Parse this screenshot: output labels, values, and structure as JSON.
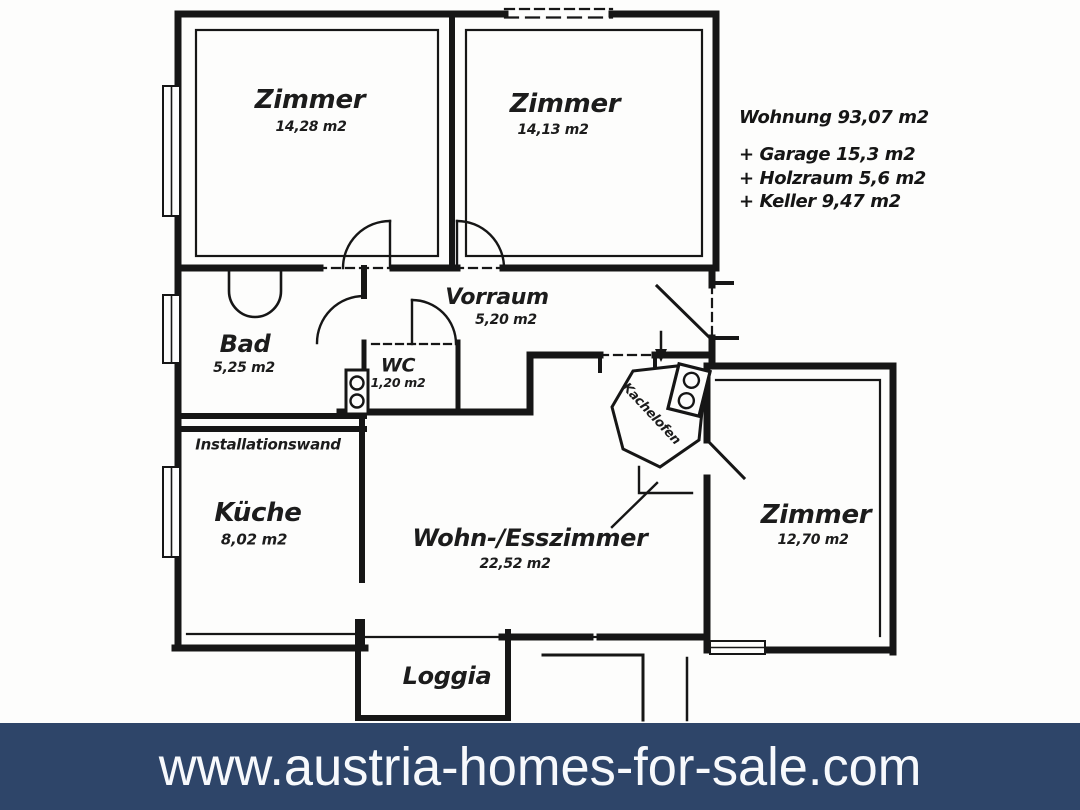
{
  "plan": {
    "rooms": {
      "zimmer1": {
        "name": "Zimmer",
        "area": "14,28 m2"
      },
      "zimmer2": {
        "name": "Zimmer",
        "area": "14,13 m2"
      },
      "vorraum": {
        "name": "Vorraum",
        "area": "5,20 m2"
      },
      "bad": {
        "name": "Bad",
        "area": "5,25 m2"
      },
      "wc": {
        "name": "WC",
        "area": "1,20 m2"
      },
      "kueche": {
        "name": "Küche",
        "area": "8,02 m2"
      },
      "wohnesszimmer": {
        "name": "Wohn-/Esszimmer",
        "area": "22,52 m2"
      },
      "zimmer3": {
        "name": "Zimmer",
        "area": "12,70 m2"
      },
      "loggia": {
        "name": "Loggia"
      }
    },
    "annotations": {
      "installationswand": "Installationswand",
      "kachelofen": "Kachelofen"
    }
  },
  "summary": {
    "wohnung": "Wohnung 93,07 m2",
    "garage": "+ Garage 15,3 m2",
    "holzraum": "+ Holzraum 5,6 m2",
    "keller": "+ Keller 9,47 m2"
  },
  "banner": {
    "url": "www.austria-homes-for-sale.com"
  },
  "colors": {
    "banner_bg": "#2e4569",
    "banner_text": "#f7f9fc",
    "ink": "#1c1c1c",
    "paper": "#fdfdfc"
  }
}
